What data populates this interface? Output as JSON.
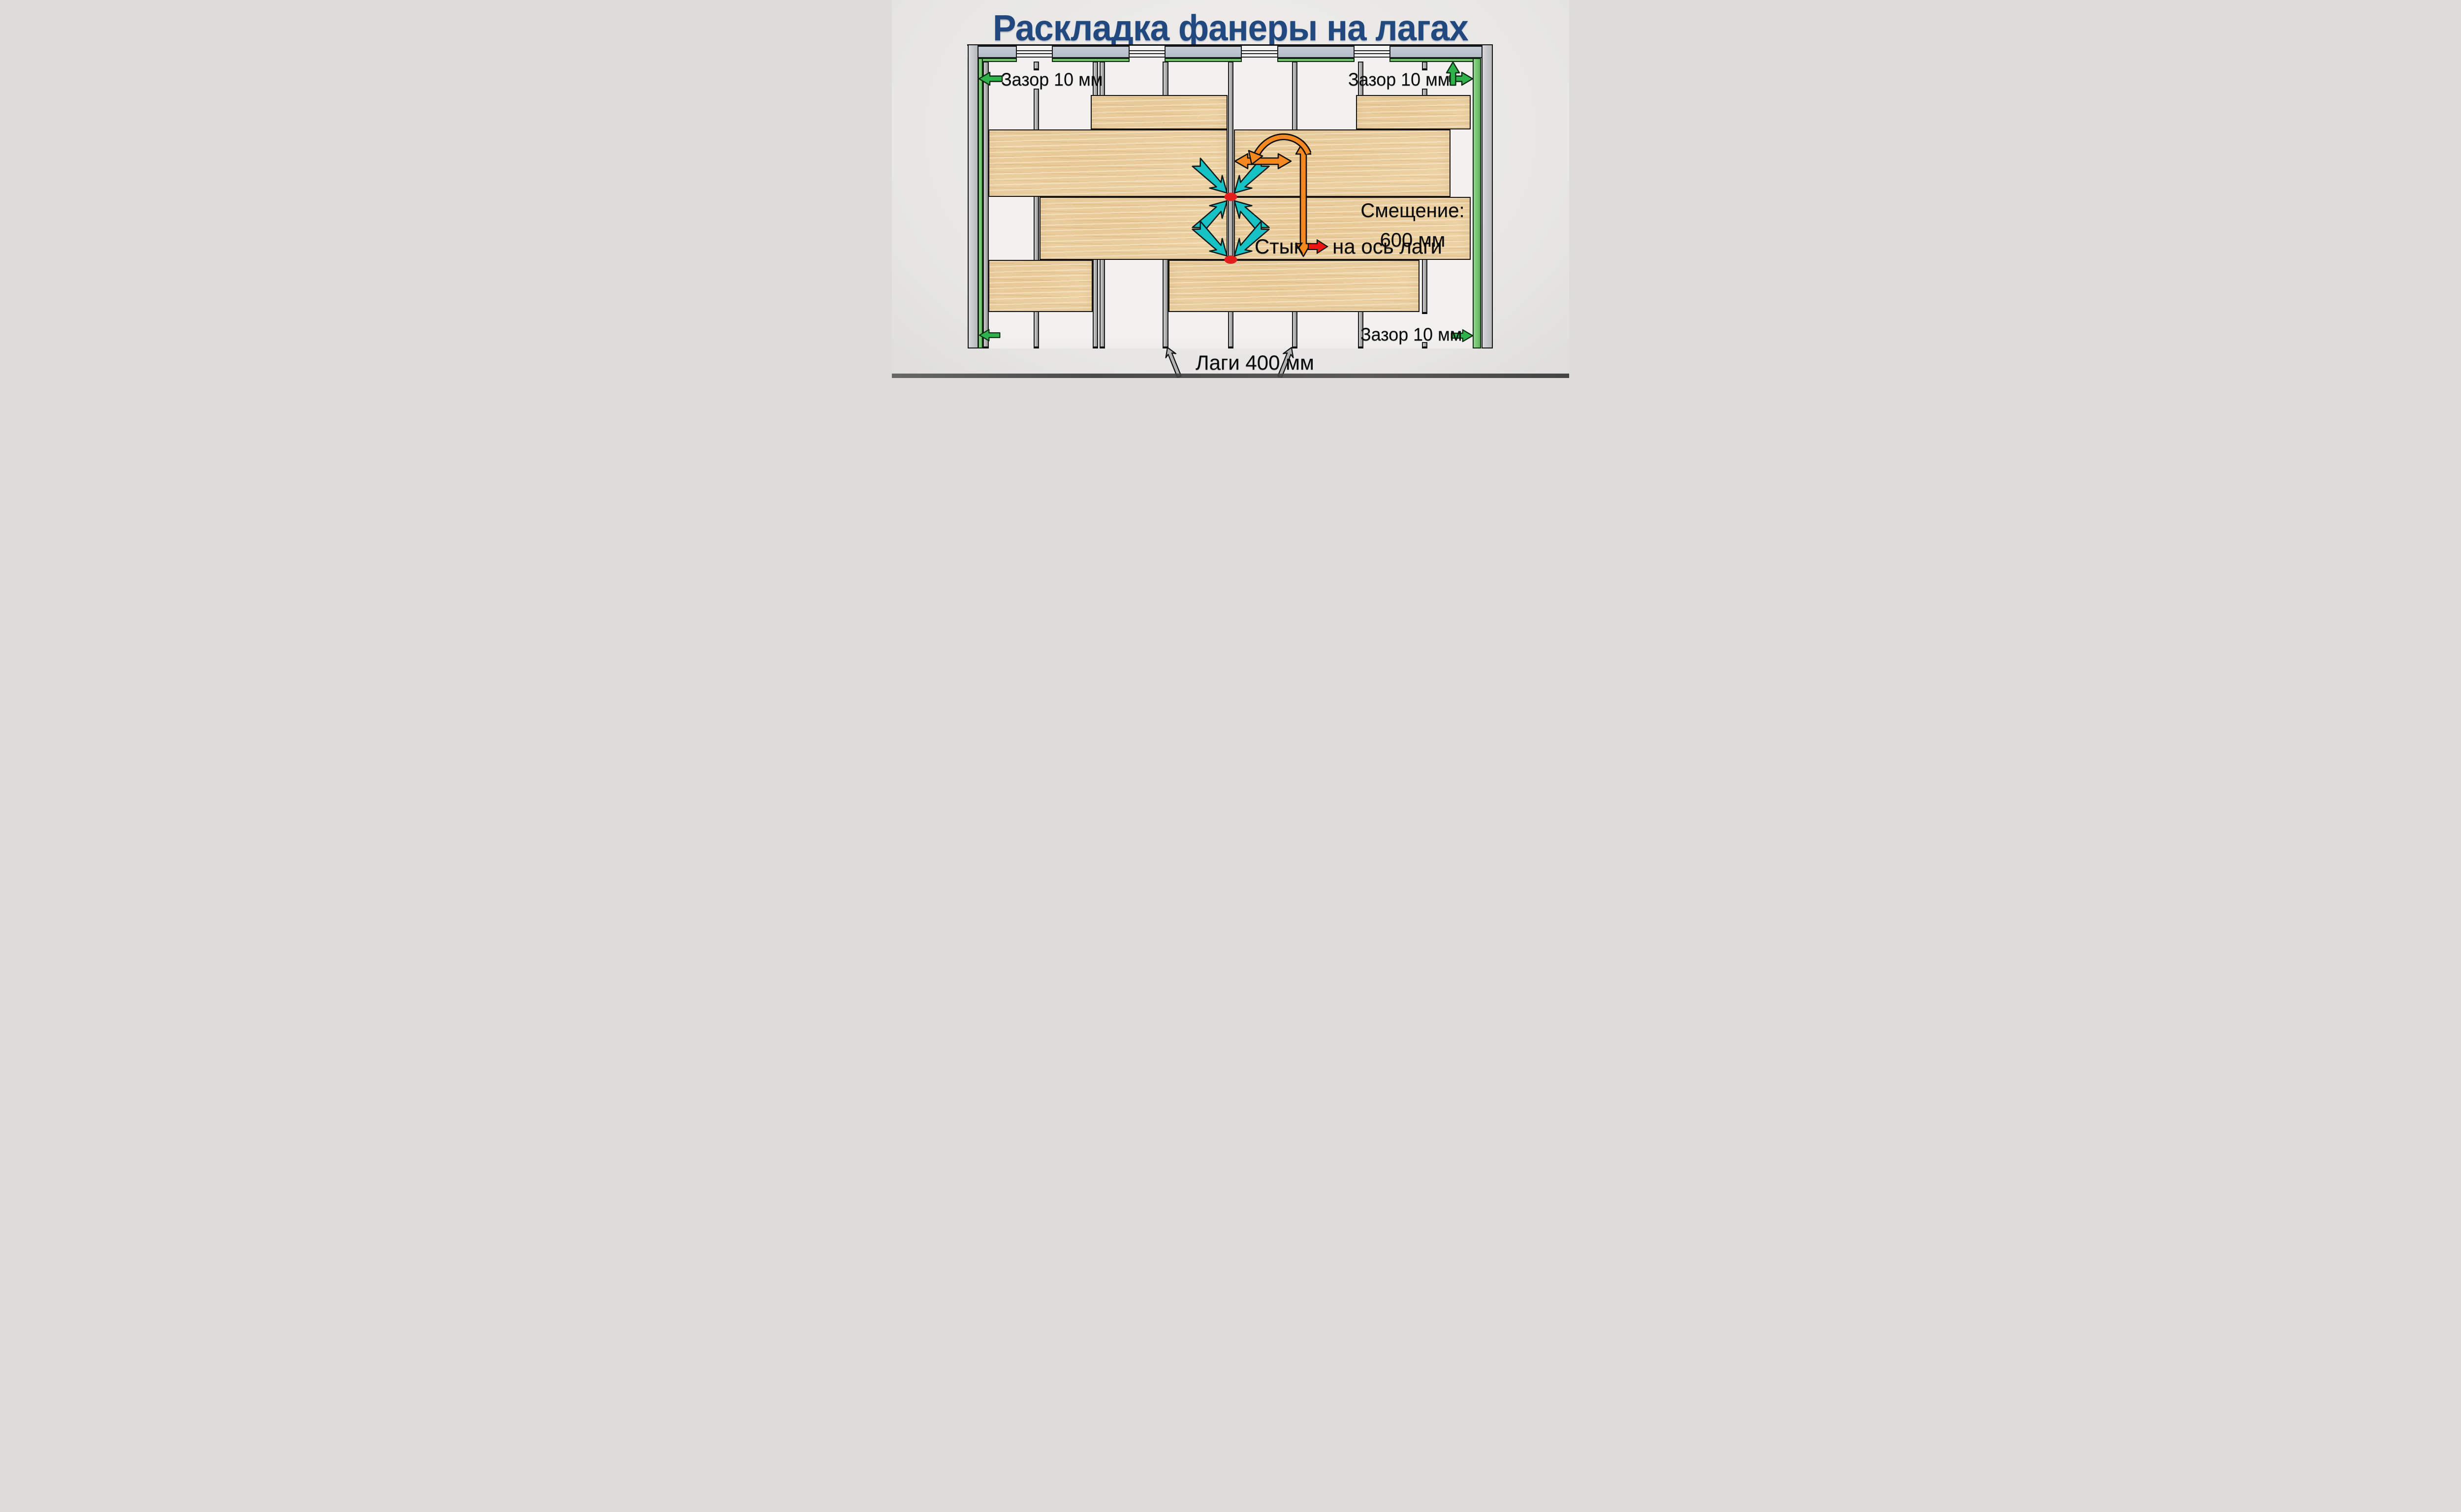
{
  "title": "Раскладка фанеры на лагах",
  "labels": {
    "gap_top_left": "Зазор 10 мм",
    "gap_top_right": "Зазор 10 мм",
    "gap_bottom_right": "Зазор 10 мм",
    "offset_line1": "Смещение:",
    "offset_line2": "600 мм",
    "joint_word": "Стык",
    "joint_rest": "на ось лаги",
    "joists_label": "Лаги 400 мм"
  },
  "colors": {
    "title_blue": "#21497f",
    "plywood": "#ecd1a3",
    "joist_gray": "#b7b7b7",
    "wall_blue_gray": "#b9c1cc",
    "gap_green": "#5db85c",
    "arrow_green": "#2fb14c",
    "arrow_cyan": "#16c2c4",
    "arrow_orange": "#f5891f",
    "arrow_gray": "#b3b3b3",
    "joint_red": "#e41d1d",
    "text_black": "#0b0b0b",
    "background": "#e9e8e6",
    "subfloor_white": "#f2f1ef"
  },
  "diagram_semantics": {
    "type": "plywood-on-joists layout scheme",
    "rows_of_sheets": 4,
    "joist_count": 9,
    "rules": [
      {
        "rule": "perimeter expansion gap",
        "value": "10 мм",
        "marked_by": "green arrows at walls"
      },
      {
        "rule": "row end-joint stagger",
        "value": "600 мм",
        "marked_by": "orange arrows"
      },
      {
        "rule": "sheet joints centered on joist axis",
        "marked_by": "cyan arrows and red dots"
      },
      {
        "rule": "joist spacing",
        "value": "400 мм",
        "marked_by": "gray arrows"
      }
    ]
  }
}
